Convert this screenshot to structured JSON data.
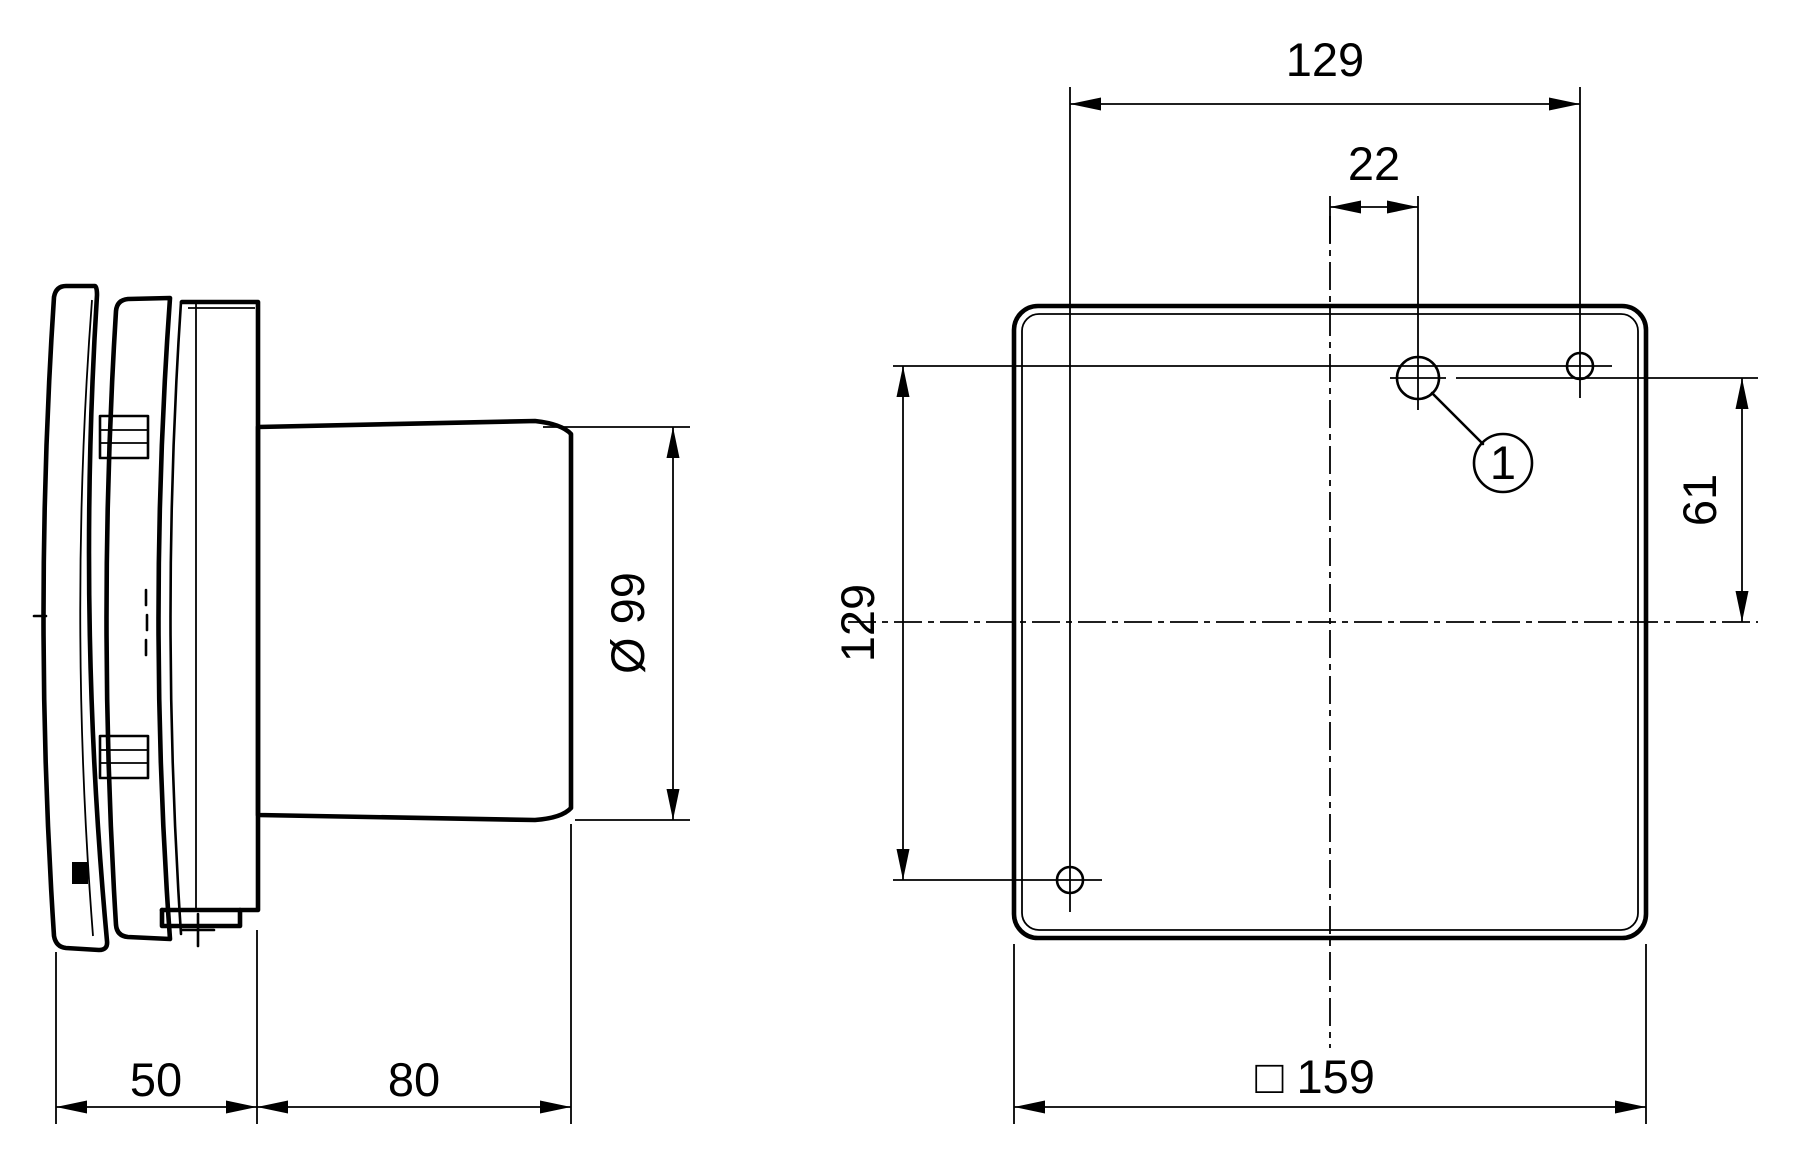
{
  "drawing": {
    "background": "#ffffff",
    "line_color": "#000000",
    "side_view": {
      "dims": {
        "front_depth": "50",
        "duct_length": "80",
        "duct_diameter": "Ø 99"
      }
    },
    "front_view": {
      "dims": {
        "hole_span_horizontal": "129",
        "hole_offset_from_center": "22",
        "hole_offset_above_center": "61",
        "hole_span_vertical": "129",
        "panel_size": "□ 159"
      },
      "callout": "1"
    }
  }
}
